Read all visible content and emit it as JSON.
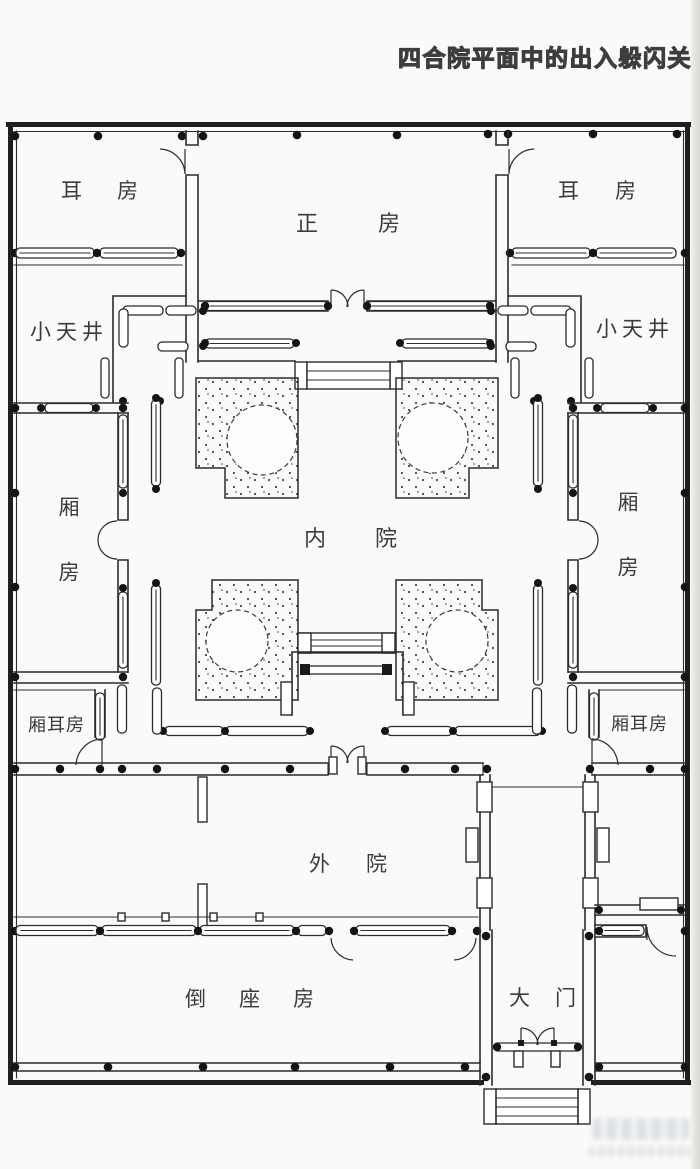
{
  "title": "四合院平面中的出入躲闪关系",
  "rooms": {
    "er_fang_left": "耳房",
    "zheng_fang": "正房",
    "er_fang_right": "耳房",
    "xiao_tianjing_left": "小天井",
    "xiao_tianjing_right": "小天井",
    "xiang_fang_left": "厢房",
    "xiang_fang_right": "厢房",
    "nei_yuan": "内院",
    "xiang_er_fang_left": "厢耳房",
    "xiang_er_fang_right": "厢耳房",
    "wai_yuan": "外院",
    "dao_zuo_fang": "倒座房",
    "da_men": "大门"
  }
}
